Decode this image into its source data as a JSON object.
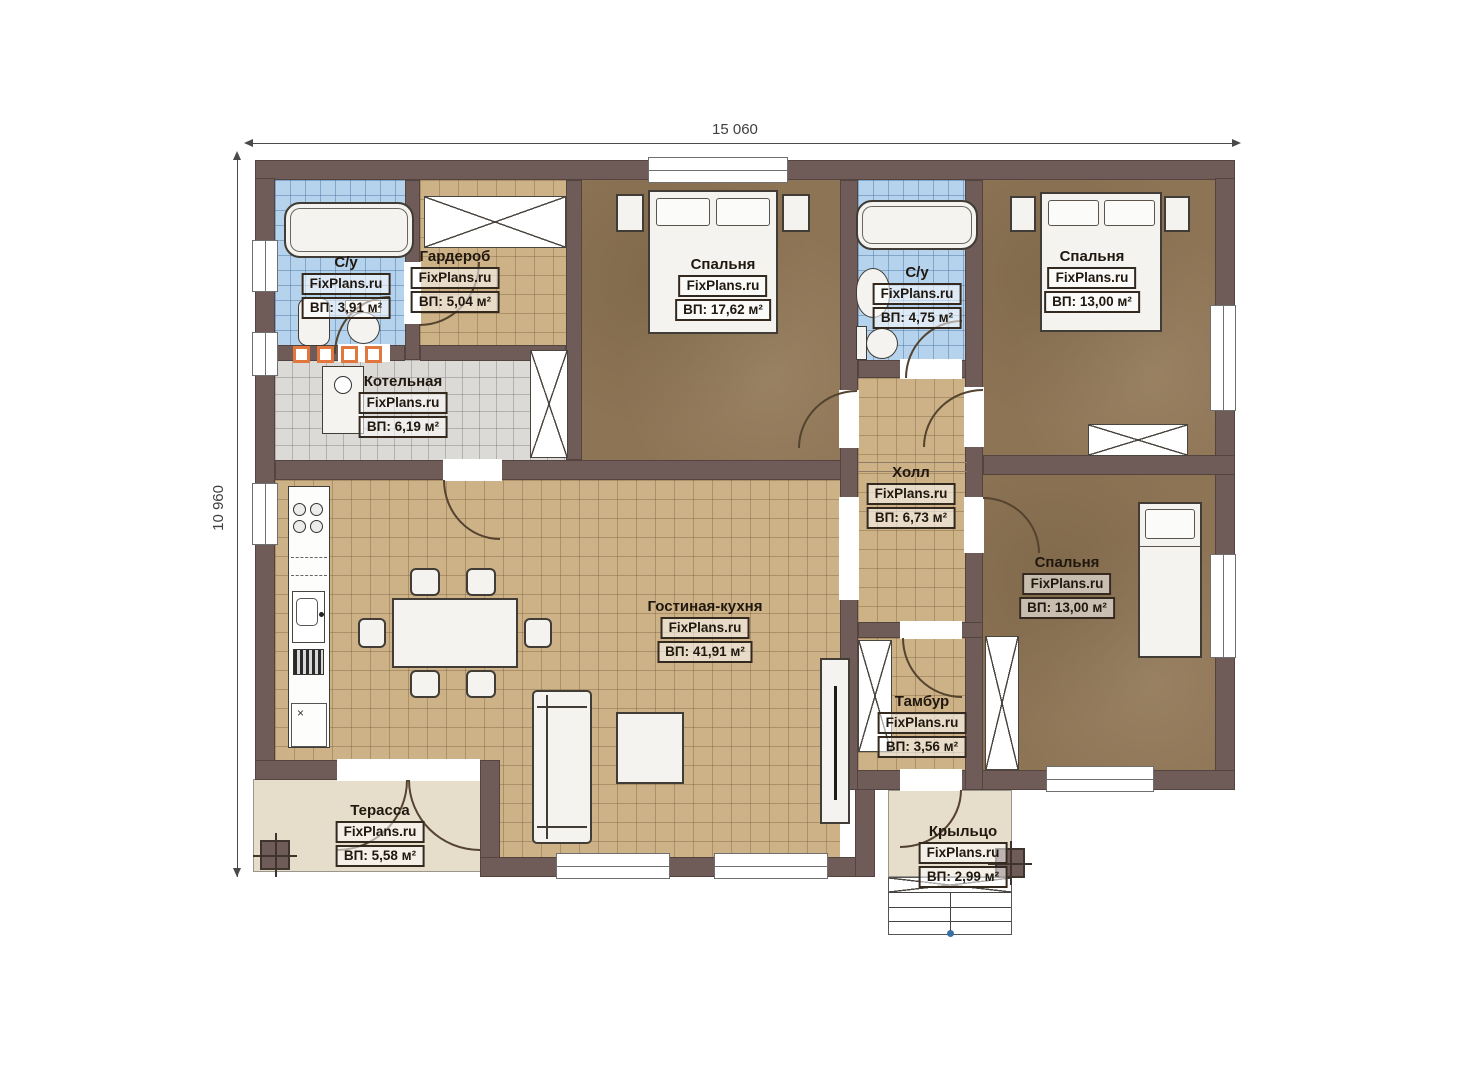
{
  "brand": "FixPlans.ru",
  "dimensions": {
    "width_label": "15 060",
    "height_label": "10 960"
  },
  "rooms": {
    "bath1": {
      "name": "С/у",
      "area": "ВП: 3,91 м²"
    },
    "wardrobe": {
      "name": "Гардероб",
      "area": "ВП: 5,04 м²"
    },
    "bedroom1": {
      "name": "Спальня",
      "area": "ВП: 17,62 м²"
    },
    "bath2": {
      "name": "С/у",
      "area": "ВП: 4,75 м²"
    },
    "bedroom2": {
      "name": "Спальня",
      "area": "ВП: 13,00 м²"
    },
    "boiler": {
      "name": "Котельная",
      "area": "ВП: 6,19 м²"
    },
    "hall": {
      "name": "Холл",
      "area": "ВП: 6,73 м²"
    },
    "living": {
      "name": "Гостиная-кухня",
      "area": "ВП: 41,91 м²"
    },
    "bedroom3": {
      "name": "Спальня",
      "area": "ВП: 13,00 м²"
    },
    "tambour": {
      "name": "Тамбур",
      "area": "ВП: 3,56 м²"
    },
    "terrace": {
      "name": "Терасса",
      "area": "ВП: 5,58 м²"
    },
    "porch": {
      "name": "Крыльцо",
      "area": "ВП: 2,99 м²"
    }
  },
  "symbols": {
    "cabinet_cross": "×"
  },
  "colors": {
    "wall": "#6f5c59",
    "tile_tan": "#cdb287",
    "tile_blue": "#b5d3ed",
    "tile_gray": "#dbdad6",
    "floor_brown": "#8d7455",
    "outdoor": "#e7ddcb",
    "accent_orange": "#e1763f"
  }
}
